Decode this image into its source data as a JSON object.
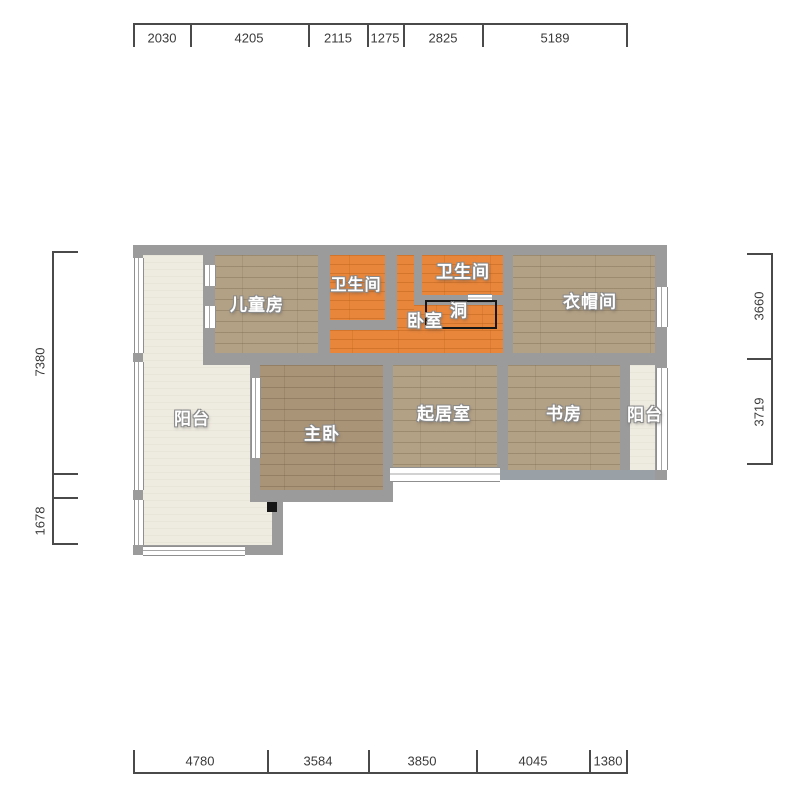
{
  "floor_plan": {
    "rooms": {
      "children_room": "儿童房",
      "bathroom_top_left": "卫生间",
      "bathroom_top_right": "卫生间",
      "bedroom": "卧室",
      "hole": "洞",
      "cloakroom": "衣帽间",
      "balcony_left": "阳台",
      "master_bedroom": "主卧",
      "living_room": "起居室",
      "study": "书房",
      "balcony_right": "阳台"
    },
    "dimensions": {
      "top": [
        "2030",
        "4205",
        "2115",
        "1275",
        "2825",
        "5189"
      ],
      "bottom": [
        "4780",
        "3584",
        "3850",
        "4045",
        "1380"
      ],
      "left": [
        "7380",
        "1678"
      ],
      "right": [
        "3660",
        "3719"
      ]
    },
    "colors": {
      "wall_gray": "#9b9b9b",
      "bottom_wall_gray": "#9aa1a6",
      "wood_floor": "#b3a185",
      "master_wood_floor": "#aa9478",
      "orange_tile": "#e8863c",
      "balcony_floor": "#eeebe0",
      "window_white": "#ffffff",
      "dimension_text": "#3a3a3a",
      "room_label_text": "#ffffff",
      "hole_outline": "#161616"
    }
  }
}
